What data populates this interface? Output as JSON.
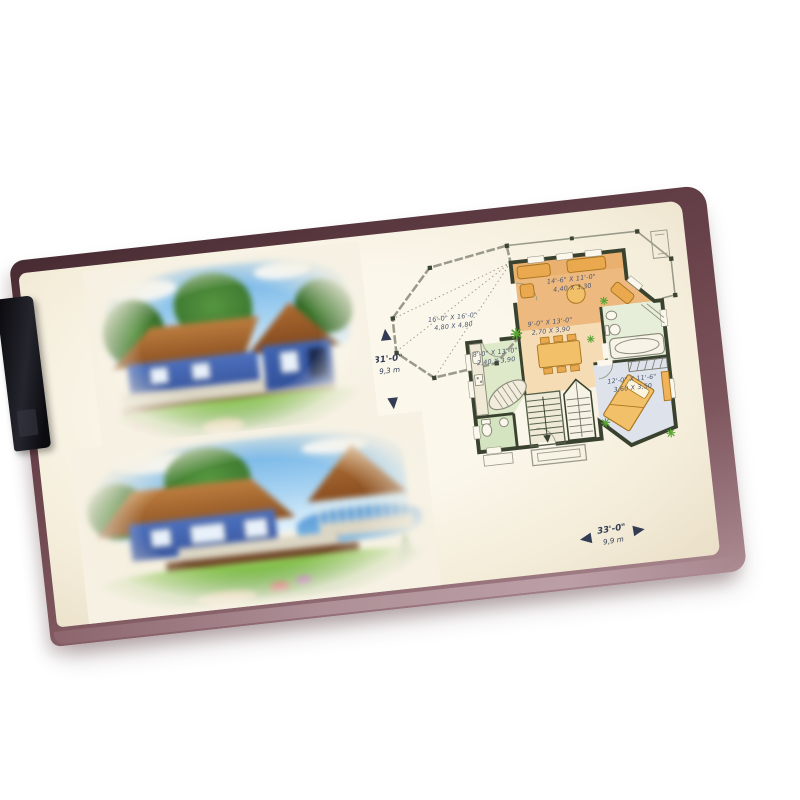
{
  "photo": {
    "background_color": "#ffffff",
    "folder_color": "#6b444c",
    "folder_edge_color": "#ad8c93",
    "clip_color": "#15151c",
    "paper_color": "#f6f1e3"
  },
  "illustrations": [
    {
      "id": "house-top",
      "subject": "blue cottage rendering, brown hip roof, trees, porch and lawn"
    },
    {
      "id": "house-bottom",
      "subject": "blue cottage rendering with round gazebo, wrap-around porch, lakeside"
    }
  ],
  "floor_plan": {
    "rooms": [
      {
        "name": "veranda",
        "dim_ft": "16'-0\" X 16'-0\"",
        "dim_m": "4,80 X 4,80"
      },
      {
        "name": "living",
        "dim_ft": "14'-6\" X 11'-0\"",
        "dim_m": "4,40 X 3,30"
      },
      {
        "name": "dining",
        "dim_ft": "9'-0\" X 13'-0\"",
        "dim_m": "2,70 X 3,90"
      },
      {
        "name": "kitchen",
        "dim_ft": "8'-0\" X 13'-0\"",
        "dim_m": "2,40 X 3,90"
      },
      {
        "name": "bedroom",
        "dim_ft": "12'-0\" X 11'-6\"",
        "dim_m": "3,60 X 3,50"
      }
    ],
    "overall_depth": {
      "ft": "31'-0\"",
      "m": "9,3 m"
    },
    "overall_width": {
      "ft": "33'-0\"",
      "m": "9,9 m"
    },
    "colors": {
      "walls": "#39422f",
      "living_floor": "#edb97e",
      "dining_floor": "#f6dcb4",
      "kitchen_floor": "#dde9c9",
      "bedroom_floor": "#dde2eb",
      "bath_floor": "#e6eed9",
      "furniture": "#eaa94e",
      "plants": "#59a434",
      "label_text": "#4a5570"
    }
  }
}
